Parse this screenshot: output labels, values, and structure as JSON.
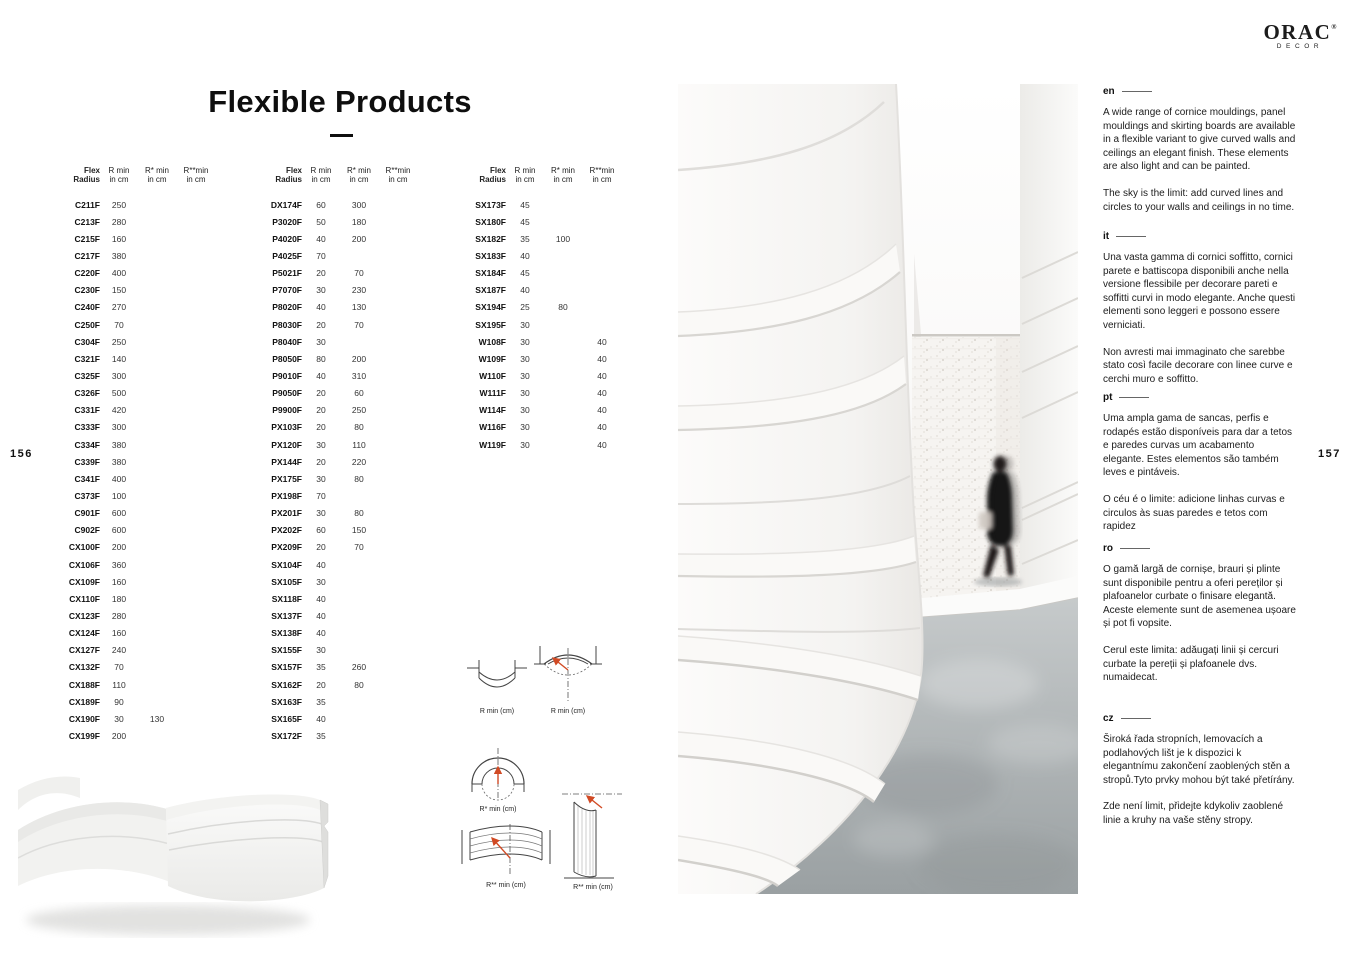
{
  "page": {
    "title": "Flexible Products",
    "left_page_number": "156",
    "right_page_number": "157"
  },
  "brand": {
    "name": "ORAC",
    "reg": "®",
    "sub": "DECOR"
  },
  "table_header": {
    "c0": "Flex Radius",
    "c1": "R min",
    "c2": "R* min",
    "c3": "R**min",
    "sub": "in cm"
  },
  "tables": [
    {
      "rows": [
        [
          "C211F",
          "250",
          "",
          ""
        ],
        [
          "C213F",
          "280",
          "",
          ""
        ],
        [
          "C215F",
          "160",
          "",
          ""
        ],
        [
          "C217F",
          "380",
          "",
          ""
        ],
        [
          "C220F",
          "400",
          "",
          ""
        ],
        [
          "C230F",
          "150",
          "",
          ""
        ],
        [
          "C240F",
          "270",
          "",
          ""
        ],
        [
          "C250F",
          "70",
          "",
          ""
        ],
        [
          "C304F",
          "250",
          "",
          ""
        ],
        [
          "C321F",
          "140",
          "",
          ""
        ],
        [
          "C325F",
          "300",
          "",
          ""
        ],
        [
          "C326F",
          "500",
          "",
          ""
        ],
        [
          "C331F",
          "420",
          "",
          ""
        ],
        [
          "C333F",
          "300",
          "",
          ""
        ],
        [
          "C334F",
          "380",
          "",
          ""
        ],
        [
          "C339F",
          "380",
          "",
          ""
        ],
        [
          "C341F",
          "400",
          "",
          ""
        ],
        [
          "C373F",
          "100",
          "",
          ""
        ],
        [
          "C901F",
          "600",
          "",
          ""
        ],
        [
          "C902F",
          "600",
          "",
          ""
        ],
        [
          "CX100F",
          "200",
          "",
          ""
        ],
        [
          "CX106F",
          "360",
          "",
          ""
        ],
        [
          "CX109F",
          "160",
          "",
          ""
        ],
        [
          "CX110F",
          "180",
          "",
          ""
        ],
        [
          "CX123F",
          "280",
          "",
          ""
        ],
        [
          "CX124F",
          "160",
          "",
          ""
        ],
        [
          "CX127F",
          "240",
          "",
          ""
        ],
        [
          "CX132F",
          "70",
          "",
          ""
        ],
        [
          "CX188F",
          "110",
          "",
          ""
        ],
        [
          "CX189F",
          "90",
          "",
          ""
        ],
        [
          "CX190F",
          "30",
          "130",
          ""
        ],
        [
          "CX199F",
          "200",
          "",
          ""
        ]
      ]
    },
    {
      "rows": [
        [
          "DX174F",
          "60",
          "300",
          ""
        ],
        [
          "P3020F",
          "50",
          "180",
          ""
        ],
        [
          "P4020F",
          "40",
          "200",
          ""
        ],
        [
          "P4025F",
          "70",
          "",
          ""
        ],
        [
          "P5021F",
          "20",
          "70",
          ""
        ],
        [
          "P7070F",
          "30",
          "230",
          ""
        ],
        [
          "P8020F",
          "40",
          "130",
          ""
        ],
        [
          "P8030F",
          "20",
          "70",
          ""
        ],
        [
          "P8040F",
          "30",
          "",
          ""
        ],
        [
          "P8050F",
          "80",
          "200",
          ""
        ],
        [
          "P9010F",
          "40",
          "310",
          ""
        ],
        [
          "P9050F",
          "20",
          "60",
          ""
        ],
        [
          "P9900F",
          "20",
          "250",
          ""
        ],
        [
          "PX103F",
          "20",
          "80",
          ""
        ],
        [
          "PX120F",
          "30",
          "110",
          ""
        ],
        [
          "PX144F",
          "20",
          "220",
          ""
        ],
        [
          "PX175F",
          "30",
          "80",
          ""
        ],
        [
          "PX198F",
          "70",
          "",
          ""
        ],
        [
          "PX201F",
          "30",
          "80",
          ""
        ],
        [
          "PX202F",
          "60",
          "150",
          ""
        ],
        [
          "PX209F",
          "20",
          "70",
          ""
        ],
        [
          "SX104F",
          "40",
          "",
          ""
        ],
        [
          "SX105F",
          "30",
          "",
          ""
        ],
        [
          "SX118F",
          "40",
          "",
          ""
        ],
        [
          "SX137F",
          "40",
          "",
          ""
        ],
        [
          "SX138F",
          "40",
          "",
          ""
        ],
        [
          "SX155F",
          "30",
          "",
          ""
        ],
        [
          "SX157F",
          "35",
          "260",
          ""
        ],
        [
          "SX162F",
          "20",
          "80",
          ""
        ],
        [
          "SX163F",
          "35",
          "",
          ""
        ],
        [
          "SX165F",
          "40",
          "",
          ""
        ],
        [
          "SX172F",
          "35",
          "",
          ""
        ]
      ]
    },
    {
      "rows": [
        [
          "SX173F",
          "45",
          "",
          ""
        ],
        [
          "SX180F",
          "45",
          "",
          ""
        ],
        [
          "SX182F",
          "35",
          "100",
          ""
        ],
        [
          "SX183F",
          "40",
          "",
          ""
        ],
        [
          "SX184F",
          "45",
          "",
          ""
        ],
        [
          "SX187F",
          "40",
          "",
          ""
        ],
        [
          "SX194F",
          "25",
          "80",
          ""
        ],
        [
          "SX195F",
          "30",
          "",
          ""
        ],
        [
          "W108F",
          "30",
          "",
          "40"
        ],
        [
          "W109F",
          "30",
          "",
          "40"
        ],
        [
          "W110F",
          "30",
          "",
          "40"
        ],
        [
          "W111F",
          "30",
          "",
          "40"
        ],
        [
          "W114F",
          "30",
          "",
          "40"
        ],
        [
          "W116F",
          "30",
          "",
          "40"
        ],
        [
          "W119F",
          "30",
          "",
          "40"
        ]
      ]
    }
  ],
  "diagrams": {
    "labels": [
      "R min (cm)",
      "R min (cm)",
      "R* min (cm)",
      "R** min (cm)",
      "R** min (cm)"
    ],
    "accent_color": "#d14a24"
  },
  "sections": [
    {
      "lang": "en",
      "p1": "A wide range of cornice mouldings, panel mouldings and skirting boards are available in a flexible variant to give curved walls and ceilings an elegant finish. These elements are also light and can be painted.",
      "p2": "The sky is the limit: add curved lines and circles to your walls and ceilings in no time."
    },
    {
      "lang": "it",
      "p1": "Una vasta gamma di cornici soffitto, cornici parete e battiscopa disponibili anche nella versione flessibile per decorare pareti e soffitti curvi in modo elegante. Anche questi elementi sono leggeri e possono essere verniciati.",
      "p2": "Non avresti mai immaginato che sarebbe stato così facile decorare con linee curve e cerchi muro e soffitto."
    },
    {
      "lang": "pt",
      "p1": "Uma ampla gama de sancas, perfis e rodapés estão disponíveis para dar a tetos e paredes curvas um acabamento elegante. Estes elementos são também leves e pintáveis.",
      "p2": "O céu é o limite: adicione linhas curvas e circulos às suas paredes e tetos com rapidez"
    },
    {
      "lang": "ro",
      "p1": "O gamă largă de cornișe, brauri și plinte sunt disponibile pentru a oferi pereților și plafoanelor curbate o finisare elegantă. Aceste elemente sunt de asemenea ușoare și pot fi vopsite.",
      "p2": "Cerul este limita: adăugați linii și cercuri curbate la pereții și plafoanele dvs. numaidecat."
    },
    {
      "lang": "cz",
      "p1": "Široká řada stropních, lemovacích a podlahových lišt je k dispozici k elegantnímu zakončení zaoblených stěn a stropů.Tyto prvky mohou být také přetírány.",
      "p2": "Zde není limit, přidejte kdykoliv zaoblené linie a kruhy na vaše stěny stropy."
    }
  ]
}
